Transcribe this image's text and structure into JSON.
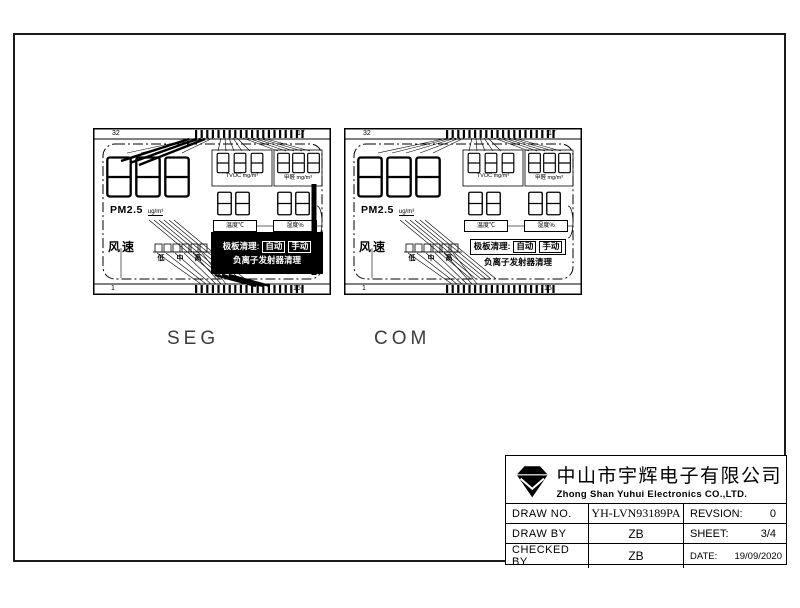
{
  "captions": {
    "seg": "SEG",
    "com": "COM"
  },
  "panel": {
    "pins": {
      "top_left": "32",
      "top_right": "17",
      "bottom_left": "1",
      "bottom_right": "16"
    },
    "labels": {
      "pm25": "PM2.5",
      "pm25_unit": "ug/m³",
      "tvoc_unit": "TVOC  mg/m³",
      "hcho_unit": "甲醛  mg/m³",
      "temperature": "温度℃",
      "humidity": "湿度%",
      "fan_speed": "风速",
      "fan_low": "低",
      "fan_mid": "中",
      "fan_high": "高",
      "plate_clean": "极板清理:",
      "auto": "自动",
      "manual": "手动",
      "ion_clean": "负离子发射器清理"
    }
  },
  "title_block": {
    "company_cn": "中山市宇辉电子有限公司",
    "company_en": "Zhong Shan Yuhui Electronics CO.,LTD.",
    "draw_no_label": "DRAW NO.",
    "draw_no": "YH-LVN93189PA",
    "revision_label": "REVSION:",
    "revision": "0",
    "draw_by_label": "DRAW BY",
    "draw_by": "ZB",
    "sheet_label": "SHEET:",
    "sheet": "3/4",
    "checked_by_label": "CHECKED BY",
    "checked_by": "ZB",
    "date_label": "DATE:",
    "date": "19/09/2020"
  }
}
